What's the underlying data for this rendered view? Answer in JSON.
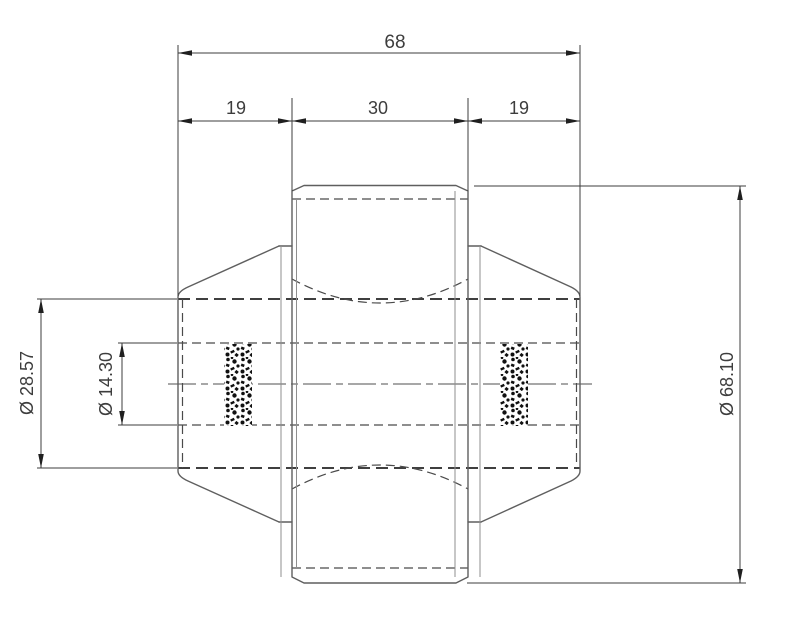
{
  "drawing": {
    "dimensions": {
      "overall_width": "68",
      "left_section_width": "19",
      "center_section_width": "30",
      "right_section_width": "19",
      "counterbore_diameter": "Ø 28.57",
      "bore_diameter": "Ø 14.30",
      "outer_diameter": "Ø 68.10"
    },
    "colors": {
      "background": "#ffffff",
      "outline": "#5f5f5f",
      "dimension_line": "#3c3c3c",
      "hidden_line": "#4a4a4a",
      "text": "#3d3d3d"
    }
  }
}
